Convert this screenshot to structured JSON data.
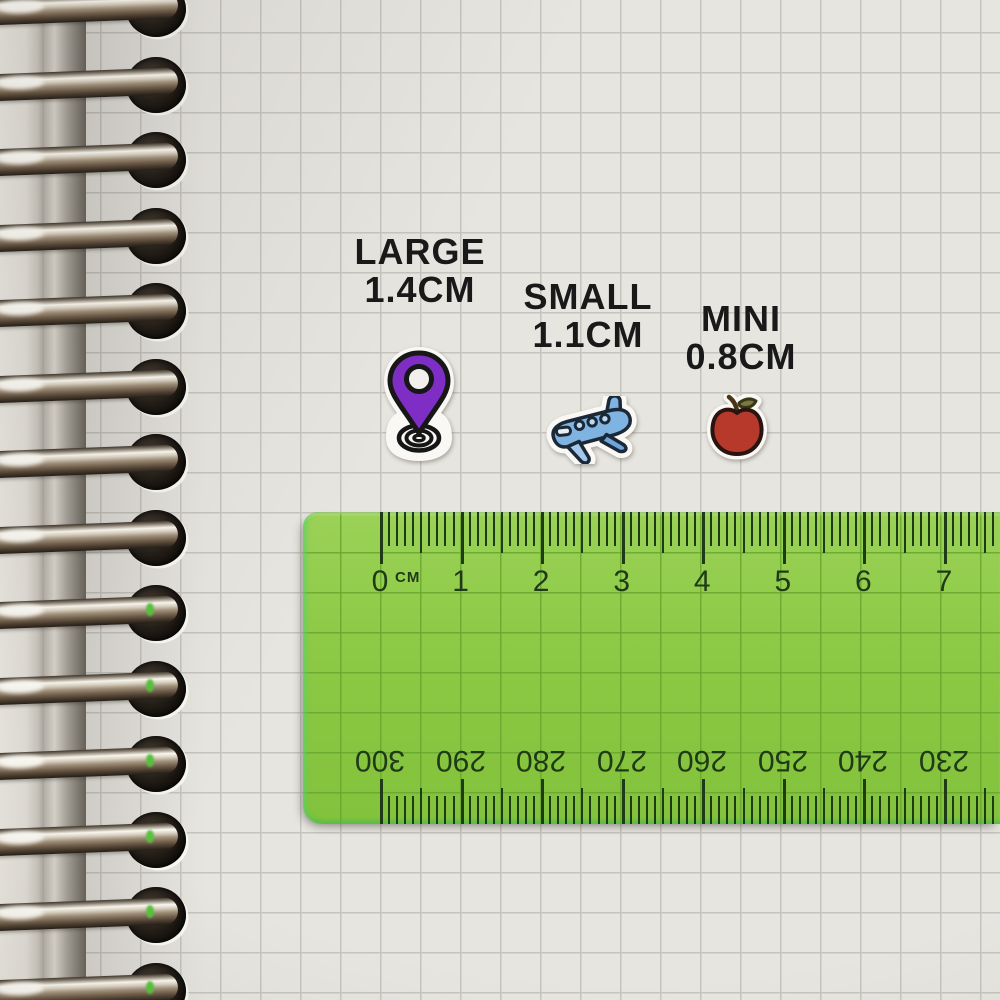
{
  "labels": [
    {
      "name": "LARGE",
      "size": "1.4CM"
    },
    {
      "name": "SMALL",
      "size": "1.1CM"
    },
    {
      "name": "MINI",
      "size": "0.8CM"
    }
  ],
  "stickers": [
    {
      "kind": "location-pin",
      "main_color": "#7e2ec4"
    },
    {
      "kind": "airplane",
      "main_color": "#7eb3e2"
    },
    {
      "kind": "apple",
      "main_color": "#b7392b"
    }
  ],
  "ruler": {
    "unit_label": "CM",
    "top_scale_numbers": [
      "0",
      "1",
      "2",
      "3",
      "4",
      "5",
      "6",
      "7"
    ],
    "bottom_scale_numbers": [
      "300",
      "290",
      "280",
      "270",
      "260",
      "250",
      "240",
      "230"
    ],
    "body_color": "#8cc944",
    "marking_color": "#1e3a16"
  },
  "paper": {
    "color": "#e7e5e0",
    "grid_color": "#c6c4be"
  }
}
